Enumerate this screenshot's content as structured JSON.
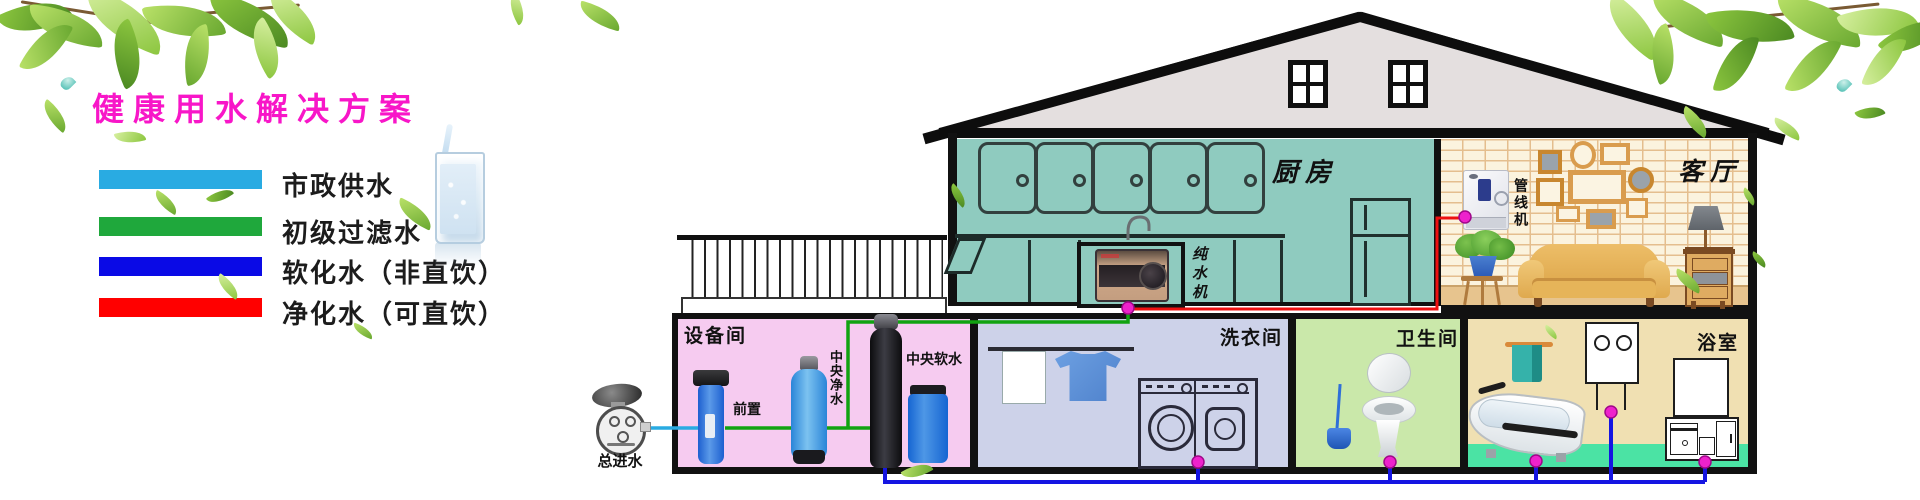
{
  "title": "健康用水解决方案",
  "legend": {
    "rows": [
      {
        "label": "市政供水",
        "color_key": "legend_cyan"
      },
      {
        "label": "初级过滤水",
        "color_key": "legend_green"
      },
      {
        "label": "软化水（非直饮）",
        "color_key": "legend_blue"
      },
      {
        "label": "净化水（可直饮）",
        "color_key": "legend_red"
      }
    ]
  },
  "house": {
    "kitchen": {
      "label": "厨房",
      "ro_machine_label": "纯水机"
    },
    "living_room": {
      "label": "客厅",
      "pipeline_machine_label": "管线机"
    },
    "equipment_room": {
      "label": "设备间",
      "prefilter": "前置",
      "central_purifier": "中央净水",
      "central_softener": "中央软水"
    },
    "laundry_room": {
      "label": "洗衣间"
    },
    "toilet_room": {
      "label": "卫生间"
    },
    "bathroom": {
      "label": "浴室"
    },
    "water_meter": {
      "label": "总进水"
    }
  },
  "colors": {
    "title_magenta": "#F816C8",
    "legend_cyan": "#29ABE2",
    "legend_green": "#1FA83C",
    "legend_blue": "#0A0AE6",
    "legend_red": "#FF0000",
    "pipe_cyan": "#29ABE2",
    "pipe_green": "#11A311",
    "pipe_blue": "#1515E2",
    "pipe_red": "#EE1111",
    "node_magenta": "#EE22CC",
    "kitchen_teal": "#8FCBBF",
    "cabinet_outline": "#32403E",
    "room_pink": "#F6CBF0",
    "room_lavender": "#CDD2E9",
    "room_green": "#CAE8AA",
    "room_tan": "#F0E0B2",
    "bath_mint": "#4BE3A4",
    "brick_bg": "#FBF3DE",
    "brick_line": "#E4BE8E",
    "gable_gray": "#E4DFDF",
    "roof_black": "#111111",
    "wood": "#D9A85F",
    "sofa_gold": "#E6B459",
    "leaf_green": "#7CBF3F"
  }
}
